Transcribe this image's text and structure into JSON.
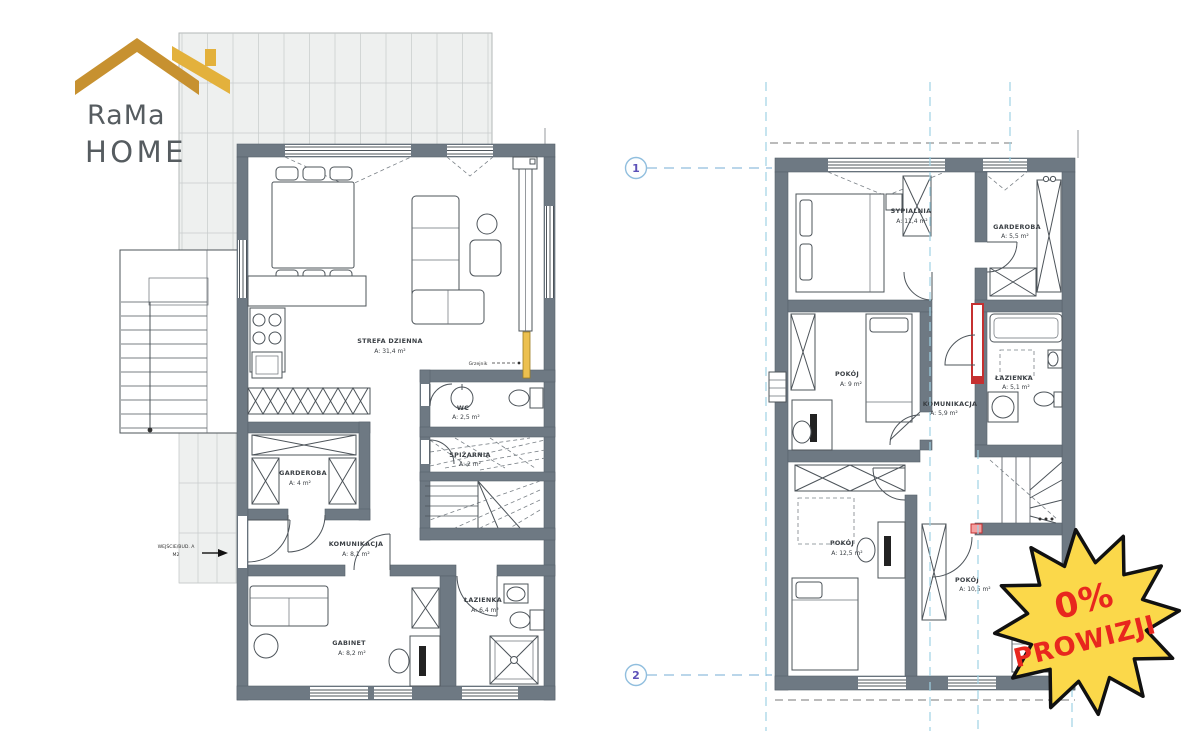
{
  "logo": {
    "line1": "RaMa",
    "line2": "HOME"
  },
  "badge": {
    "line1": "0%",
    "line2": "PROWIZJI"
  },
  "entrance": {
    "line1": "WEJŚCIE/BUD. A",
    "line2": "M2"
  },
  "heater_label": "Grzejnik",
  "axis_markers": {
    "m1": "1",
    "m2": "2"
  },
  "ground_floor": {
    "rooms": [
      {
        "name": "STREFA DZIENNA",
        "area": "A: 31,4 m²"
      },
      {
        "name": "WC",
        "area": "A: 2,5 m²"
      },
      {
        "name": "SPIŻARNIA",
        "area": "A: 2 m²"
      },
      {
        "name": "GARDEROBA",
        "area": "A: 4 m²"
      },
      {
        "name": "KOMUNIKACJA",
        "area": "A: 8,1 m²"
      },
      {
        "name": "ŁAZIENKA",
        "area": "A: 6,4 m²"
      },
      {
        "name": "GABINET",
        "area": "A: 8,2 m²"
      }
    ]
  },
  "upper_floor": {
    "rooms": [
      {
        "name": "SYPIALNIA",
        "area": "A: 11,4 m²"
      },
      {
        "name": "GARDEROBA",
        "area": "A: 5,5 m²"
      },
      {
        "name": "POKÓJ",
        "area": "A: 9 m²"
      },
      {
        "name": "KOMUNIKACJA",
        "area": "A: 5,9 m²"
      },
      {
        "name": "ŁAZIENKA",
        "area": "A: 5,1 m²"
      },
      {
        "name": "POKÓJ",
        "area": "A: 12,5 m²"
      },
      {
        "name": "POKÓJ",
        "area": "A: 10,5 m²"
      }
    ]
  },
  "colors": {
    "brand_gold_dark": "#C79130",
    "brand_gold_light": "#E3B13C",
    "logo_text": "#565C60",
    "wall_gray": "#6E7983",
    "axis_blue": "#9FD3E4",
    "marker_number": "#5B50B8",
    "badge_fill": "#FBD84A",
    "badge_border": "#111111",
    "badge_text": "#E8271E",
    "radiator_red": "#C53030",
    "radiator_yellow": "#ECC04F"
  }
}
